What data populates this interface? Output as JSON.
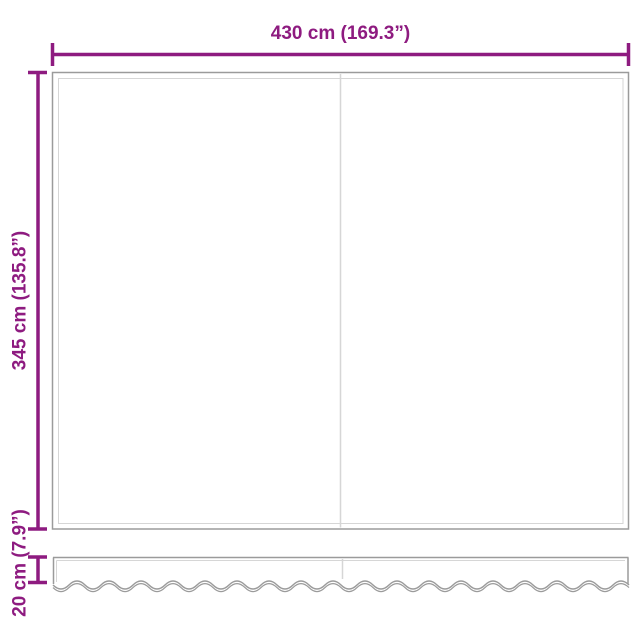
{
  "dimensions": {
    "width": {
      "label": "430 cm (169.3”)"
    },
    "height": {
      "label": "345 cm (135.8”)"
    },
    "valance_height": {
      "label": "20 cm (7.9”)"
    }
  },
  "colors": {
    "accent": "#8e1b80",
    "outline": "#9b9b9b",
    "outline_light": "#d6d6d6"
  }
}
